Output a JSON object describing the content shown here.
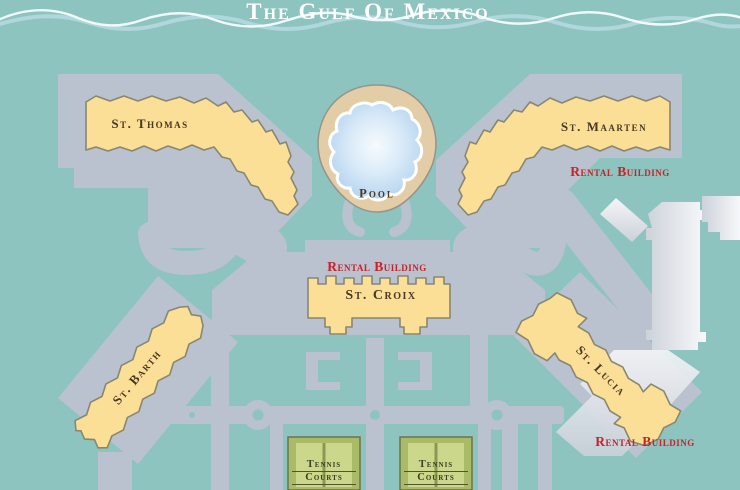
{
  "title": "The Gulf Of Mexico",
  "pool_label": "Pool",
  "rental_label": "Rental Building",
  "tennis": {
    "line1": "Tennis",
    "line2": "Courts"
  },
  "buildings": [
    {
      "id": "st-thomas",
      "label": "St. Thomas",
      "rental_building": false
    },
    {
      "id": "st-maarten",
      "label": "St. Maarten",
      "rental_building": true
    },
    {
      "id": "st-croix",
      "label": "St. Croix",
      "rental_building": true
    },
    {
      "id": "st-barth",
      "label": "St. Barth",
      "rental_building": false
    },
    {
      "id": "st-lucia",
      "label": "St. Lucia",
      "rental_building": true
    }
  ],
  "colors": {
    "background": "#8ec4bf",
    "road": "#b9c2ce",
    "building_fill": "#fbdf97",
    "building_outline": "#88876f",
    "label_text": "#4a3822",
    "rental_text": "#c92128",
    "pool_deck": "#e2cda7",
    "pool_water": "#aecfee",
    "tennis_court": "#a9bb67",
    "tennis_court_panel": "#cbd88b",
    "title_text": "#ffffff"
  }
}
